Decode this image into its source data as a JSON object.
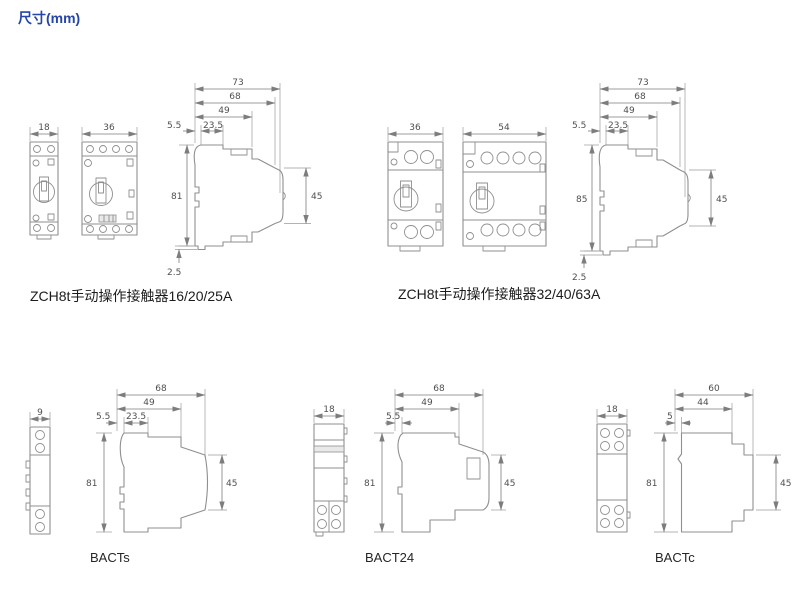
{
  "title": "尺寸(mm)",
  "colors": {
    "title_blue": "#2545a8",
    "line_gray": "#8f8f8f",
    "dim_text_gray": "#4f4f4f",
    "label_black": "#1c1c1c"
  },
  "groups": [
    {
      "label": "ZCH8t手动操作接触器16/20/25A",
      "fronts": [
        {
          "width": "18"
        },
        {
          "width": "36"
        }
      ],
      "side": {
        "total_depth": "73",
        "body_depth": "68",
        "front_depth": "49",
        "top_front": "23.5",
        "top_back": "5.5",
        "height": "81",
        "front_height": "45",
        "foot": "2.5"
      }
    },
    {
      "label": "ZCH8t手动操作接触器32/40/63A",
      "fronts": [
        {
          "width": "36"
        },
        {
          "width": "54"
        }
      ],
      "side": {
        "total_depth": "73",
        "body_depth": "68",
        "front_depth": "49",
        "top_front": "23.5",
        "top_back": "5.5",
        "height": "85",
        "front_height": "45",
        "foot": "2.5"
      }
    },
    {
      "label": "BACTs",
      "fronts": [
        {
          "width": "9"
        }
      ],
      "side": {
        "body_depth": "68",
        "front_depth": "49",
        "top_front": "23.5",
        "top_back": "5.5",
        "height": "81",
        "front_height": "45"
      }
    },
    {
      "label": "BACT24",
      "fronts": [
        {
          "width": "18"
        }
      ],
      "side": {
        "body_depth": "68",
        "front_depth": "49",
        "top_back": "5.5",
        "height": "81",
        "front_height": "45"
      }
    },
    {
      "label": "BACTc",
      "fronts": [
        {
          "width": "18"
        }
      ],
      "side": {
        "body_depth": "60",
        "front_depth": "44",
        "top_back": "5",
        "height": "81",
        "front_height": "45"
      }
    }
  ]
}
